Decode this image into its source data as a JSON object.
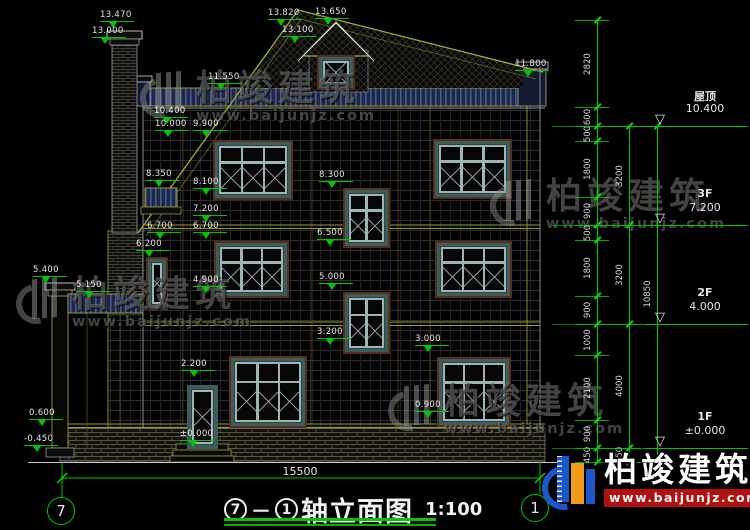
{
  "title": {
    "axis_from": "7",
    "axis_to": "1",
    "name": "轴立面图",
    "scale": "1:100"
  },
  "overall_dim": "15500",
  "brand": {
    "name": "柏竣建筑",
    "site": "www.baijunjz.com"
  },
  "colors": {
    "dim_green": "#00c800",
    "line_yellow": "#a8a832",
    "text_white": "#e6e6e6",
    "logo_blue": "#1b57c8",
    "logo_orange": "#f29b1d",
    "logo_red": "#b01010"
  },
  "floor_levels": [
    {
      "name": "屋顶",
      "elev": "10.400",
      "y": 126
    },
    {
      "name": "3F",
      "elev": "7.200",
      "y": 225
    },
    {
      "name": "2F",
      "elev": "4.000",
      "y": 324
    },
    {
      "name": "1F",
      "elev": "±0.000",
      "y": 448
    }
  ],
  "elevation_markers": [
    {
      "label": "13.470",
      "x": 100,
      "y": 11
    },
    {
      "label": "13.000",
      "x": 92,
      "y": 27
    },
    {
      "label": "13.820",
      "x": 268,
      "y": 9
    },
    {
      "label": "13.650",
      "x": 315,
      "y": 8
    },
    {
      "label": "13.100",
      "x": 282,
      "y": 26
    },
    {
      "label": "11.550",
      "x": 208,
      "y": 73
    },
    {
      "label": "11.800",
      "x": 515,
      "y": 60
    },
    {
      "label": "10.400",
      "x": 154,
      "y": 107
    },
    {
      "label": "10.000",
      "x": 155,
      "y": 120
    },
    {
      "label": "9.900",
      "x": 193,
      "y": 120
    },
    {
      "label": "8.350",
      "x": 146,
      "y": 170
    },
    {
      "label": "8.100",
      "x": 193,
      "y": 178
    },
    {
      "label": "8.300",
      "x": 319,
      "y": 171
    },
    {
      "label": "7.200",
      "x": 193,
      "y": 205
    },
    {
      "label": "6.700",
      "x": 147,
      "y": 222
    },
    {
      "label": "6.700",
      "x": 193,
      "y": 222
    },
    {
      "label": "6.500",
      "x": 317,
      "y": 229
    },
    {
      "label": "6.200",
      "x": 136,
      "y": 240
    },
    {
      "label": "5.400",
      "x": 33,
      "y": 266
    },
    {
      "label": "5.150",
      "x": 76,
      "y": 281
    },
    {
      "label": "5.000",
      "x": 319,
      "y": 273
    },
    {
      "label": "4.900",
      "x": 193,
      "y": 276
    },
    {
      "label": "3.200",
      "x": 317,
      "y": 328
    },
    {
      "label": "3.000",
      "x": 415,
      "y": 335
    },
    {
      "label": "2.200",
      "x": 181,
      "y": 360
    },
    {
      "label": "0.900",
      "x": 415,
      "y": 401
    },
    {
      "label": "0.600",
      "x": 29,
      "y": 409
    },
    {
      "label": "±0.000",
      "x": 180,
      "y": 430
    },
    {
      "label": "-0.450",
      "x": 24,
      "y": 435
    }
  ],
  "dim_chains": [
    {
      "x": 597,
      "boundaries": [
        20,
        107,
        126,
        141,
        197,
        225,
        240,
        296,
        324,
        355,
        420,
        448,
        462
      ],
      "labels": [
        "2820",
        "600",
        "500",
        "1800",
        "900",
        "500",
        "1800",
        "900",
        "1000",
        "2100",
        "900",
        "450"
      ]
    },
    {
      "x": 629,
      "boundaries": [
        126,
        225,
        324,
        448,
        462
      ],
      "labels": [
        "3200",
        "3200",
        "4000",
        "450"
      ]
    },
    {
      "x": 657,
      "boundaries": [
        126,
        462
      ],
      "labels": [
        "10850"
      ]
    }
  ],
  "windows": [
    {
      "name": "window-3f-left",
      "x": 213,
      "y": 140,
      "w": 80,
      "h": 60,
      "cols": 3
    },
    {
      "name": "window-3f-right",
      "x": 433,
      "y": 139,
      "w": 79,
      "h": 60,
      "cols": 3
    },
    {
      "name": "window-stair-3f",
      "x": 343,
      "y": 188,
      "w": 47,
      "h": 60,
      "cols": 2
    },
    {
      "name": "window-2f-left",
      "x": 214,
      "y": 241,
      "w": 75,
      "h": 57,
      "cols": 3
    },
    {
      "name": "window-2f-right",
      "x": 435,
      "y": 241,
      "w": 77,
      "h": 57,
      "cols": 3
    },
    {
      "name": "window-stair-2f",
      "x": 343,
      "y": 292,
      "w": 47,
      "h": 62,
      "cols": 2
    },
    {
      "name": "window-1f-mid",
      "x": 229,
      "y": 356,
      "w": 78,
      "h": 72,
      "cols": 3
    },
    {
      "name": "window-1f-right",
      "x": 437,
      "y": 357,
      "w": 74,
      "h": 70,
      "cols": 3
    },
    {
      "name": "window-narrow-left",
      "x": 146,
      "y": 257,
      "w": 22,
      "h": 53,
      "cols": 1
    },
    {
      "name": "window-dormer",
      "x": 317,
      "y": 55,
      "w": 38,
      "h": 35,
      "cols": 1
    }
  ],
  "door": {
    "name": "entry-door",
    "x": 187,
    "y": 385,
    "w": 31,
    "h": 64
  },
  "axis_bubbles": [
    {
      "label": "7",
      "x": 47,
      "y": 497
    },
    {
      "label": "1",
      "x": 521,
      "y": 494
    }
  ],
  "watermark_positions": [
    {
      "x": 140,
      "y": 70
    },
    {
      "x": 16,
      "y": 276
    },
    {
      "x": 490,
      "y": 178
    },
    {
      "x": 388,
      "y": 383
    }
  ]
}
